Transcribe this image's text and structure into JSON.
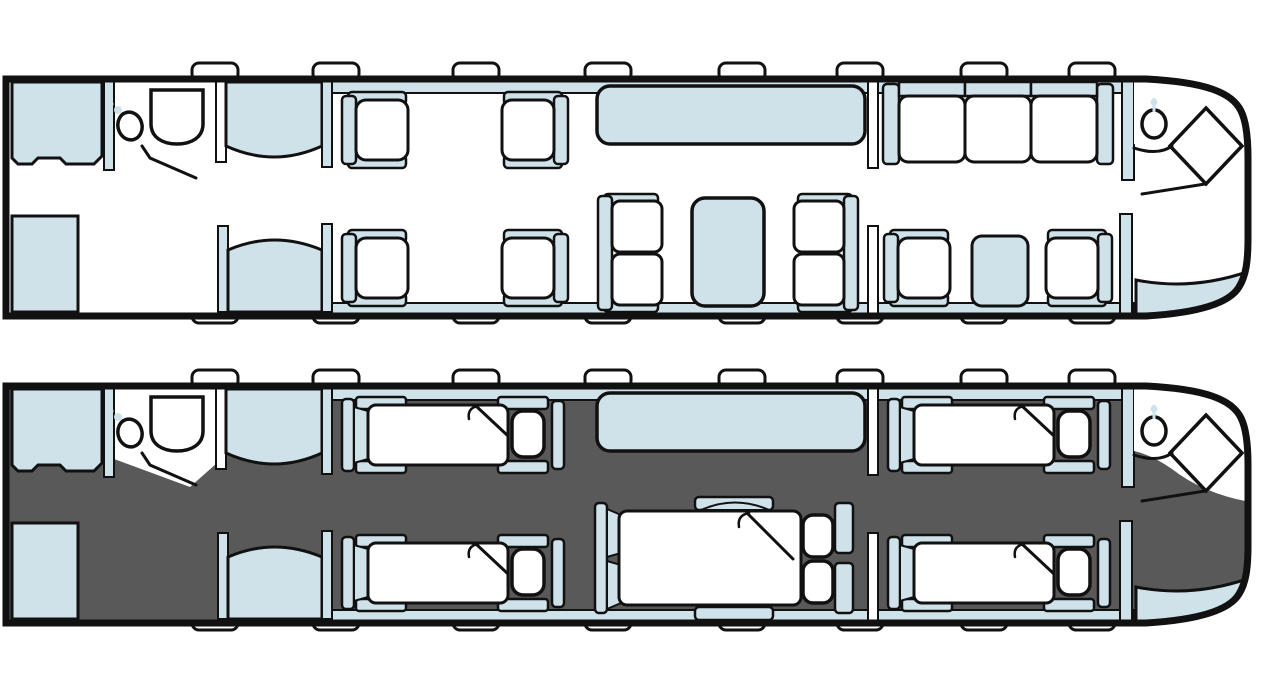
{
  "colors": {
    "background": "#ffffff",
    "outline": "#111111",
    "white": "#ffffff",
    "upholstery": "#cfe2ea",
    "night_floor": "#595959"
  },
  "diagram": {
    "type": "aircraft-cabin-floor-plan",
    "windows_per_side": 8,
    "plans": [
      {
        "id": "day-configuration",
        "floor": "white",
        "components": [
          "forward-cabinet",
          "forward-lavatory-toilet",
          "forward-lavatory-sink",
          "wardrobe-upper",
          "wardrobe-lower",
          "entry-door-pad",
          "club-seat-x4",
          "long-divan",
          "conference-double-seat-x2",
          "conference-table",
          "three-place-sofa",
          "aft-club-seat-x2",
          "side-table",
          "aft-lavatory-sink",
          "aft-vanity-diamond",
          "aft-closet"
        ]
      },
      {
        "id": "night-configuration",
        "floor": "dark",
        "components": [
          "forward-cabinet",
          "forward-lavatory-toilet",
          "forward-lavatory-sink",
          "wardrobe-upper",
          "wardrobe-lower",
          "entry-door-pad",
          "single-bed-x4",
          "long-divan",
          "double-bed",
          "aft-lavatory-sink",
          "aft-vanity-diamond",
          "aft-closet"
        ]
      }
    ]
  }
}
